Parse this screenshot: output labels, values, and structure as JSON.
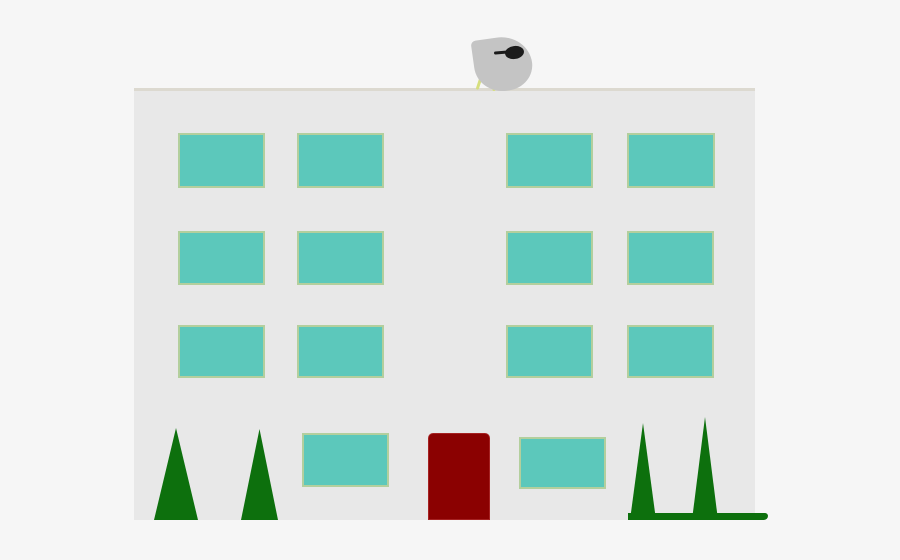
{
  "scene": {
    "description": "clipart-of-apartment-building-with-satellite-dish-and-trees",
    "background_color": "#f6f6f6",
    "canvas": {
      "x": 0,
      "y": 0,
      "w": 900,
      "h": 560,
      "color": "#f6f6f6"
    },
    "building": {
      "body": {
        "x": 134,
        "y": 90,
        "w": 621,
        "h": 430,
        "color": "#e8e8e8"
      },
      "roof_line": {
        "x": 134,
        "y": 88,
        "w": 621,
        "h": 3,
        "color": "#dcd9d0"
      }
    },
    "windows": {
      "fill": "#5cc8bb",
      "border_color": "#b3cf9d",
      "items": [
        {
          "x": 178,
          "y": 133,
          "w": 87,
          "h": 55
        },
        {
          "x": 297,
          "y": 133,
          "w": 87,
          "h": 55
        },
        {
          "x": 506,
          "y": 133,
          "w": 87,
          "h": 55
        },
        {
          "x": 627,
          "y": 133,
          "w": 88,
          "h": 55
        },
        {
          "x": 178,
          "y": 231,
          "w": 87,
          "h": 54
        },
        {
          "x": 297,
          "y": 231,
          "w": 87,
          "h": 54
        },
        {
          "x": 506,
          "y": 231,
          "w": 87,
          "h": 54
        },
        {
          "x": 627,
          "y": 231,
          "w": 87,
          "h": 54
        },
        {
          "x": 178,
          "y": 325,
          "w": 87,
          "h": 53
        },
        {
          "x": 297,
          "y": 325,
          "w": 87,
          "h": 53
        },
        {
          "x": 506,
          "y": 325,
          "w": 87,
          "h": 53
        },
        {
          "x": 627,
          "y": 325,
          "w": 87,
          "h": 53
        },
        {
          "x": 302,
          "y": 433,
          "w": 87,
          "h": 54
        },
        {
          "x": 519,
          "y": 437,
          "w": 87,
          "h": 52
        }
      ]
    },
    "door": {
      "x": 428,
      "y": 433,
      "w": 62,
      "h": 87,
      "color": "#8b0101"
    },
    "trees": {
      "color": "#0d700d",
      "items": [
        {
          "x": 154,
          "y": 428,
          "w": 44,
          "h": 92
        },
        {
          "x": 241,
          "y": 429,
          "w": 37,
          "h": 91
        },
        {
          "x": 630,
          "y": 423,
          "w": 26,
          "h": 97
        },
        {
          "x": 692,
          "y": 417,
          "w": 26,
          "h": 103
        }
      ],
      "grass_strip": {
        "x": 628,
        "y": 513,
        "w": 140,
        "h": 7,
        "color": "#0d700d"
      }
    },
    "satellite_dish": {
      "reflector": {
        "x": 474,
        "y": 37,
        "w": 58,
        "h": 54,
        "color": "#c4c4c4"
      },
      "feed_horn": {
        "x": 505,
        "y": 46,
        "w": 19,
        "h": 13,
        "color": "#1b1b1b"
      },
      "feed_arm": {
        "x": 494,
        "y": 51,
        "w": 15,
        "h": 3,
        "color": "#1b1b1b"
      },
      "legs": {
        "color": "#d6df7e",
        "items": [
          {
            "x": 479,
            "y": 68,
            "w": 3,
            "h": 22,
            "rotate": 18
          },
          {
            "x": 493,
            "y": 72,
            "w": 3,
            "h": 19,
            "rotate": 4
          }
        ]
      }
    }
  }
}
